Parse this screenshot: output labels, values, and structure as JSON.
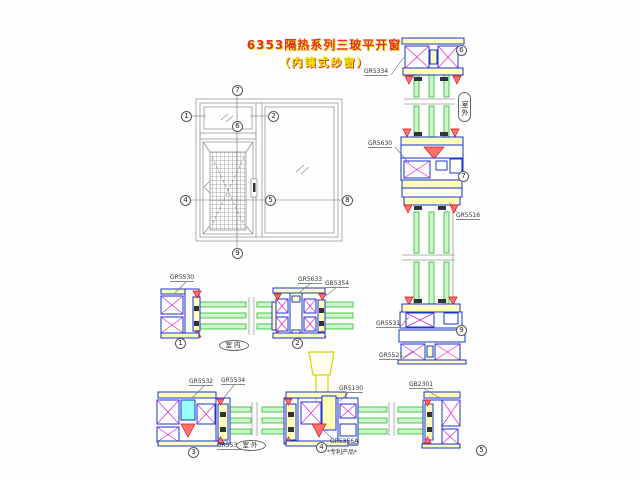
{
  "title": {
    "line1": "6353隔热系列三玻平开窗",
    "line2": "（内镶式纱窗）"
  },
  "callouts": {
    "c1": "1",
    "c2": "2",
    "c3": "3",
    "c4": "4",
    "c5": "5",
    "c6": "6",
    "c7": "7",
    "c8": "8",
    "c9": "9"
  },
  "labels": {
    "gr5334": "GR5334",
    "gr5630": "GR5630",
    "gr5516": "GR5516",
    "gr5531": "GR5531",
    "gr5521": "GR5521",
    "gr5530": "GR5530",
    "gr5633": "GR5633",
    "gb5354": "GB5354",
    "gr5532": "GR5532",
    "gr5534": "GR5534",
    "gr5535": "GR5535",
    "gr5130": "GR5130",
    "gr5356a": "GR5356A",
    "patent": "*专利产品*",
    "gb2301": "GB2301"
  },
  "annotations": {
    "indoor": "室内",
    "outdoor": "室外",
    "outdoor_vertical": "室外"
  },
  "colors": {
    "profile_blue": "#1535cc",
    "thermal_break_magenta": "#e020e0",
    "glass_green": "#2abf2a",
    "gasket_red": "#dd1111",
    "filler_yellow": "#ffffbb",
    "highlight_cyan": "#99ffff",
    "handle_yellow": "#d6d600",
    "title_red": "#e03030",
    "title_yellow": "#eeee00"
  }
}
